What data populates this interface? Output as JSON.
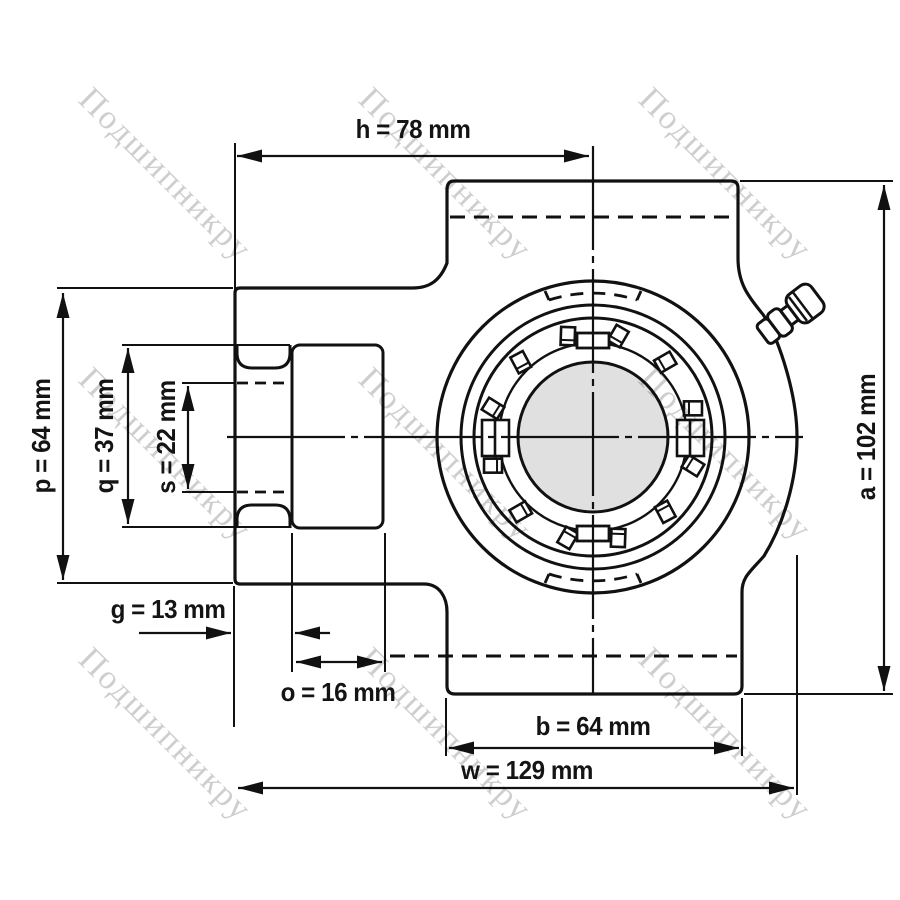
{
  "watermark": {
    "text": "Подшипникру"
  },
  "drawing": {
    "unit": "mm",
    "dimensions": {
      "h": {
        "label": "h = 78 mm",
        "value": 78
      },
      "p": {
        "label": "p = 64 mm",
        "value": 64
      },
      "q": {
        "label": "q = 37 mm",
        "value": 37
      },
      "s": {
        "label": "s = 22 mm",
        "value": 22
      },
      "a": {
        "label": "a = 102 mm",
        "value": 102
      },
      "g": {
        "label": "g = 13 mm",
        "value": 13
      },
      "o": {
        "label": "o = 16 mm",
        "value": 16
      },
      "b": {
        "label": "b = 64 mm",
        "value": 64
      },
      "w": {
        "label": "w = 129 mm",
        "value": 129
      }
    },
    "colors": {
      "line": "#111111",
      "bore_fill": "#e0e0e0",
      "watermark": "#c6c6c6",
      "background": "#ffffff"
    }
  }
}
